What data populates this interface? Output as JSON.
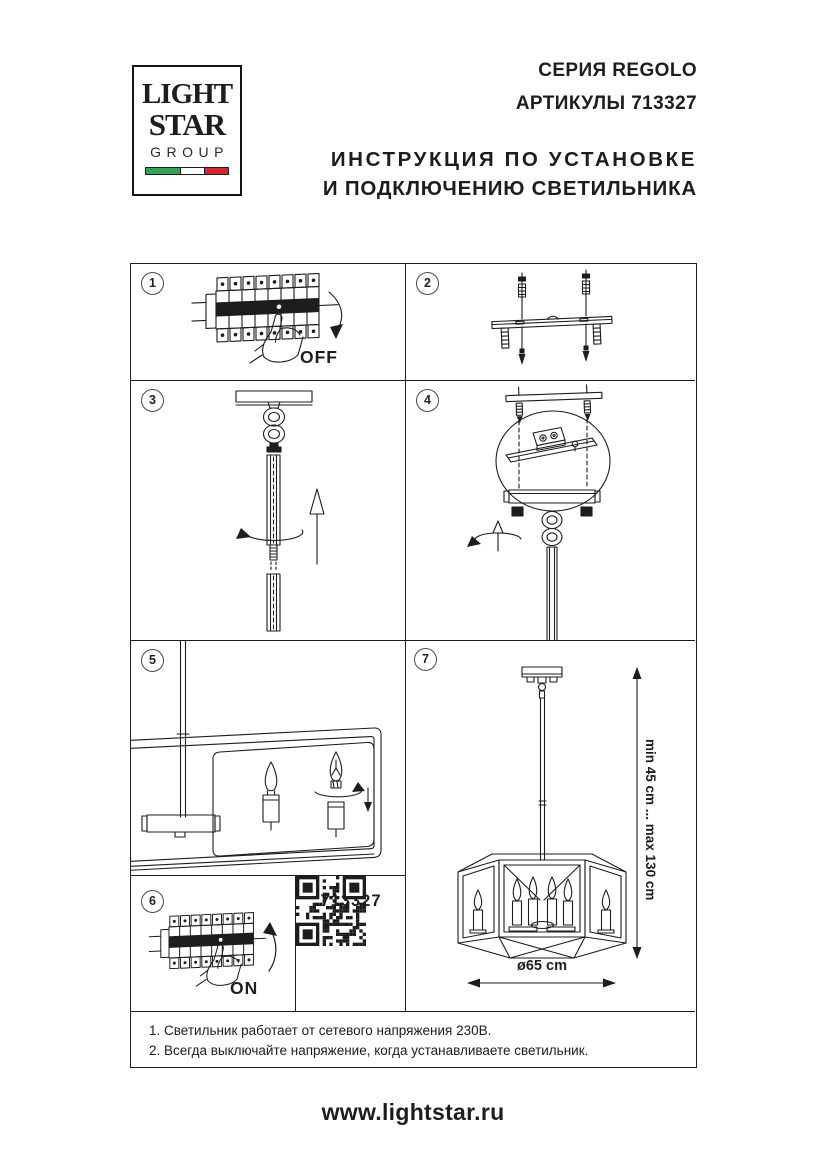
{
  "colors": {
    "ink": "#1d1d1b",
    "flag_green": "#33a457",
    "flag_red": "#d8232a"
  },
  "logo": {
    "line1": "LIGHT",
    "line2": "STAR",
    "line3": "GROUP"
  },
  "header": {
    "series": "СЕРИЯ REGOLO",
    "articles": "АРТИКУЛЫ 713327",
    "title_line1": "ИНСТРУКЦИЯ ПО УСТАНОВКЕ",
    "title_line2": "И ПОДКЛЮЧЕНИЮ СВЕТИЛЬНИКА"
  },
  "steps": {
    "s1": {
      "num": "1",
      "label": "OFF"
    },
    "s2": {
      "num": "2"
    },
    "s3": {
      "num": "3"
    },
    "s4": {
      "num": "4"
    },
    "s5": {
      "num": "5"
    },
    "s6": {
      "num": "6",
      "label": "ON"
    },
    "s7": {
      "num": "7",
      "height_range": "min 45 cm ... max 130 cm",
      "diameter": "ø65 cm"
    }
  },
  "qr_panel": {
    "article": "713327"
  },
  "notes": {
    "line1": "1. Светильник работает от сетевого напряжения 230В.",
    "line2": "2. Всегда выключайте напряжение, когда устанавливаете светильник."
  },
  "footer": {
    "website": "www.lightstar.ru"
  }
}
